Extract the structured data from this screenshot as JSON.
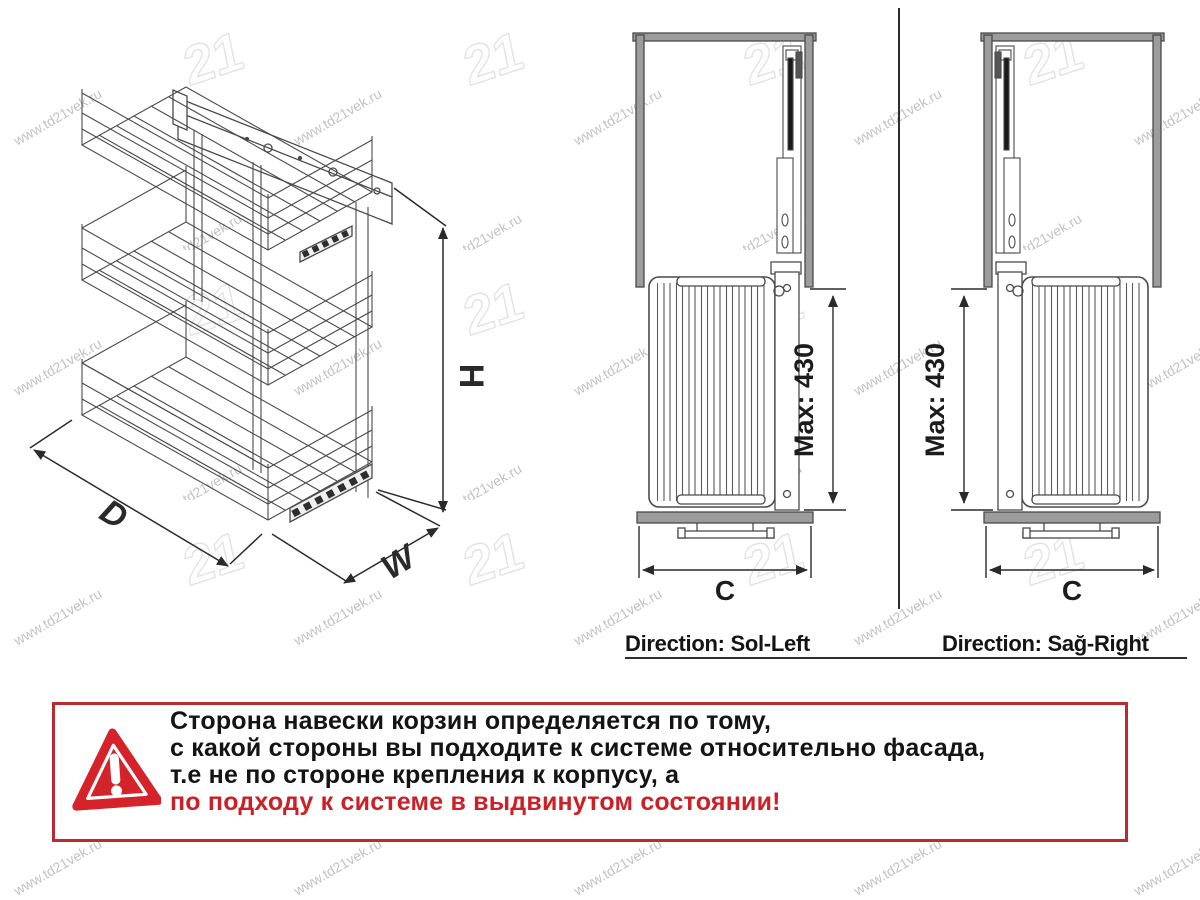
{
  "watermark": {
    "text": "www.td21vek.ru",
    "logo": "21"
  },
  "iso_view": {
    "depth_label": "D",
    "width_label": "W",
    "height_label": "H"
  },
  "front_views": {
    "left": {
      "direction_label": "Direction: Sol-Left",
      "max_label": "Max: 430",
      "width_label": "C"
    },
    "right": {
      "direction_label": "Direction: Sağ-Right",
      "max_label": "Max: 430",
      "width_label": "C"
    }
  },
  "warning": {
    "lines": [
      "Сторона навески корзин определяется по тому,",
      "с какой стороны вы подходите к системе относительно фасада,",
      "т.е не по стороне крепления к корпусу, а"
    ],
    "highlight_line": "по подходу к системе в выдвинутом состоянии!"
  },
  "colors": {
    "warning_border": "#b72b31",
    "warning_accent": "#cc2026",
    "cabinet_gray": "#9c9c9c",
    "line_dark": "#3f3f3f"
  }
}
